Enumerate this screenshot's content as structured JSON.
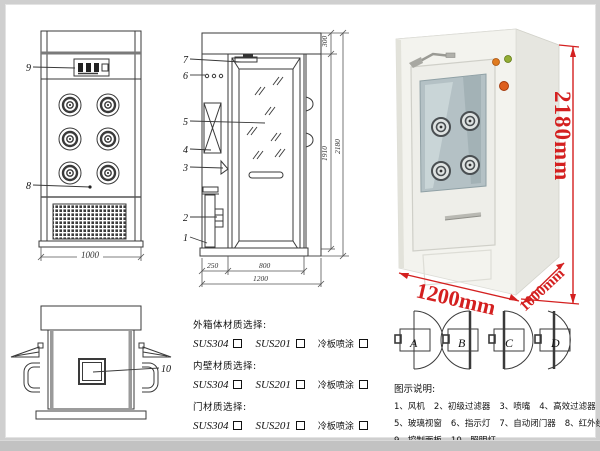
{
  "front_view": {
    "callout_9": "9",
    "callout_8": "8",
    "dim_width": "1000"
  },
  "side_view": {
    "callouts": [
      "7",
      "6",
      "5",
      "4",
      "3",
      "2",
      "1"
    ],
    "dim_top": "300",
    "dim_inner_height": "1910",
    "dim_total_height": "2180",
    "dim_left": "250",
    "dim_door": "800",
    "dim_total_width": "1200"
  },
  "photo": {
    "dim_height": "2180mm",
    "dim_width": "1200mm",
    "dim_depth": "1000mm",
    "dim_color": "#d42020"
  },
  "top_view": {
    "callout_10": "10"
  },
  "materials": {
    "sections": [
      {
        "label": "外箱体材质选择:",
        "options": [
          "SUS304",
          "SUS201",
          "冷板喷涂"
        ]
      },
      {
        "label": "内壁材质选择:",
        "options": [
          "SUS304",
          "SUS201",
          "冷板喷涂"
        ]
      },
      {
        "label": "门材质选择:",
        "options": [
          "SUS304",
          "SUS201",
          "冷板喷涂"
        ]
      }
    ]
  },
  "door_options": {
    "a": "A",
    "b": "B",
    "c": "C",
    "d": "D"
  },
  "legend": {
    "title": "图示说明:",
    "items": [
      "1、风机",
      "2、初级过滤器",
      "3、喷嘴",
      "4、高效过滤器",
      "5、玻璃视窗",
      "6、指示灯",
      "7、自动闭门器",
      "8、红外线感应器",
      "9、控制面板",
      "10、照明灯"
    ]
  }
}
